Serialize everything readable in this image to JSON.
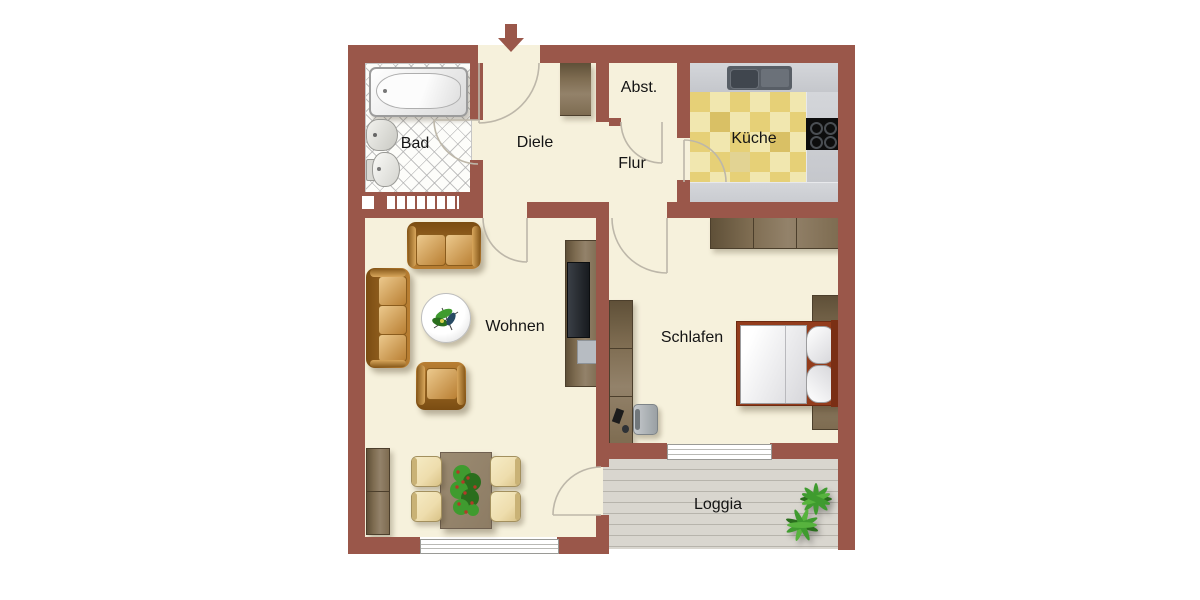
{
  "rooms": {
    "bad": {
      "label": "Bad"
    },
    "diele": {
      "label": "Diele"
    },
    "abstellraum": {
      "label": "Abst."
    },
    "flur": {
      "label": "Flur"
    },
    "kueche": {
      "label": "Küche"
    },
    "wohnen": {
      "label": "Wohnen"
    },
    "schlafen": {
      "label": "Schlafen"
    },
    "loggia": {
      "label": "Loggia"
    }
  },
  "icons": {
    "entrance": "arrow-down"
  },
  "colors": {
    "wall": "#9a574a",
    "floor": "#f6f1dc",
    "bathTile": "#fdfdfa",
    "counter": "#c5c7cc",
    "tileLight": "#f1e7af",
    "tileDark": "#e6d077",
    "deck": "#d9d6cf",
    "deckLine": "#b7b4ac",
    "wood": "#7e6c51",
    "woodDark": "#5f5038",
    "leather": "#b97f33",
    "leatherLight": "#ecc98d",
    "leatherDark": "#7a4c12",
    "chair": "#eeddad",
    "tableWood": "#8d7c64",
    "bedFrame": "#933c1c",
    "green": "#3f9b2f",
    "greenDark": "#2a6e1d",
    "berry": "#b33a28",
    "arcStroke": "#bdb7a9"
  }
}
